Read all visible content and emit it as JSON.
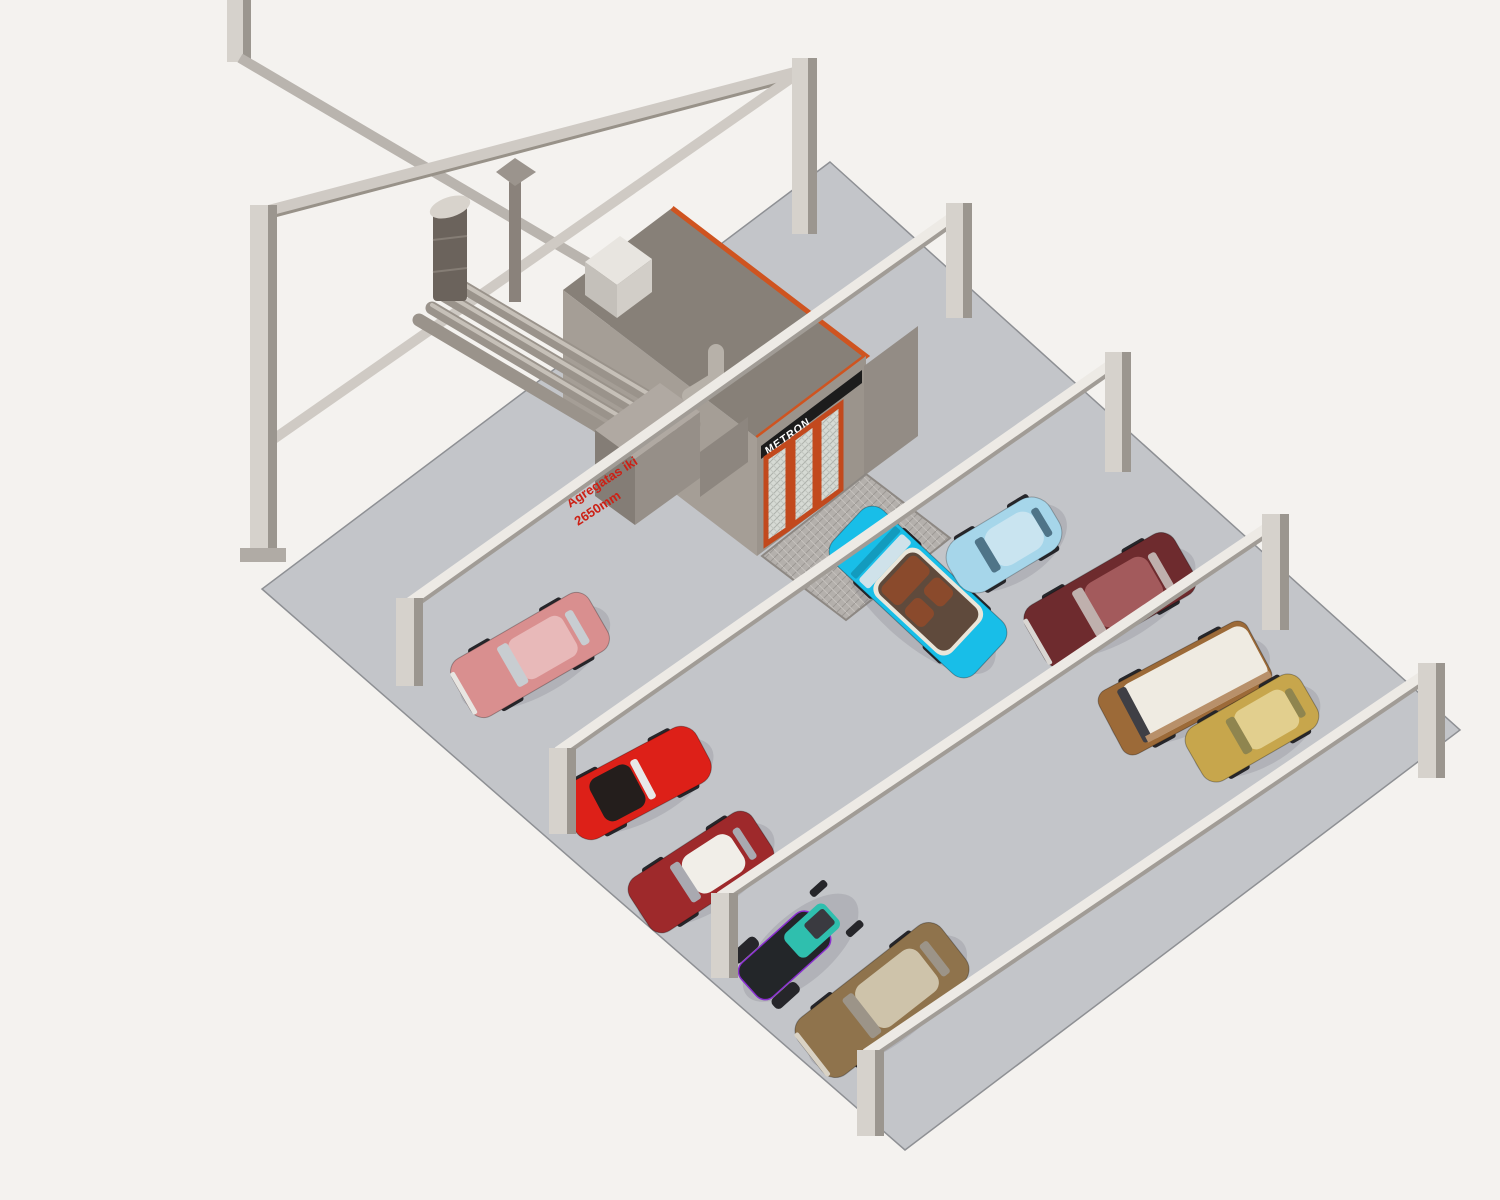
{
  "scene": {
    "kind": "isometric 3D CAD render of a car workshop / garage floor",
    "booth": {
      "brand_label": "METRON"
    },
    "annotation": {
      "line1": "Agregatas iki",
      "line2": "2650mm"
    }
  },
  "colors": {
    "background": "#f4f2ef",
    "floor": "#c3c5c9",
    "floor_edge": "#8e9094",
    "beam_light": "#edeae5",
    "beam_shadow": "#a19c96",
    "gantry_beam": "#cfcac4",
    "post_face": "#d6d2cc",
    "post_side": "#9b968f",
    "post_pad": "#b0aba5",
    "booth_roof": "#878078",
    "booth_front": "#9b948c",
    "booth_side": "#a59e96",
    "booth_wall": "#938c85",
    "trim_orange": "#cf5420",
    "door_frame_orange": "#c2491d",
    "door_mesh": "#d6dad4",
    "logo_band": "#1c1c1c",
    "logo_text": "#ffffff",
    "unit_top": "#b0a9a2",
    "unit_front": "#968f88",
    "unit_side": "#847d76",
    "duct": "#9a938b",
    "duct_highlight": "#c6c0b8",
    "chimney": "#6b635c",
    "chimney_cap": "#d8d3cc",
    "pipe": "#8a827b",
    "plenum_top": "#e8e5e0",
    "plenum_front": "#d2cec8",
    "plenum_side": "#c4c0ba",
    "ramp_base": "#b4b0ac",
    "annotation_red": "#cc2015",
    "wheel": "#26262a",
    "shadow": "#70737c"
  },
  "cars": [
    {
      "name": "cyan convertible at booth exit",
      "body": "#18bee8",
      "accent": "#8a4a2c",
      "trim": "#eae6da",
      "glass": "#cfe2ea",
      "interior": "#5f4a3c"
    },
    {
      "name": "light blue beetle",
      "body": "#a6d6ea",
      "accent": "#c9e4f0",
      "trim": "#dce8ee",
      "glass": "#4f7488"
    },
    {
      "name": "dark red fastback",
      "body": "#6e2b2e",
      "accent": "#a35a5c",
      "trim": "#d9d6d2",
      "glass": "#bfb0ad"
    },
    {
      "name": "brown and white van",
      "body": "#9c6a38",
      "accent": "#efebe2",
      "trim": "#b8906a",
      "glass": "#3f3f45"
    },
    {
      "name": "gold classic car",
      "body": "#c7a64c",
      "accent": "#8f854f",
      "trim": "#e2cf8e",
      "glass": "#8f854f"
    },
    {
      "name": "pink hatchback",
      "body": "#d98f8f",
      "accent": "#c8cdd1",
      "trim": "#e8b9b9",
      "glass": "#c8cdd1"
    },
    {
      "name": "red roadster",
      "body": "#dd2018",
      "accent": "#241e1c",
      "trim": "#e8e8e8",
      "glass": "#e8e8e8"
    },
    {
      "name": "maroon car with white roof",
      "body": "#9e292b",
      "accent": "#f1eee8",
      "trim": "#6f1d1f",
      "glass": "#a9a9b0"
    },
    {
      "name": "black and teal hot rod",
      "body": "#232629",
      "accent": "#2fbfae",
      "trim": "#8a2fd0",
      "glass": "#3a3a40"
    },
    {
      "name": "bronze sedan",
      "body": "#8f734c",
      "accent": "#cec3aa",
      "trim": "#d9d2c4",
      "glass": "#9c9488"
    }
  ]
}
